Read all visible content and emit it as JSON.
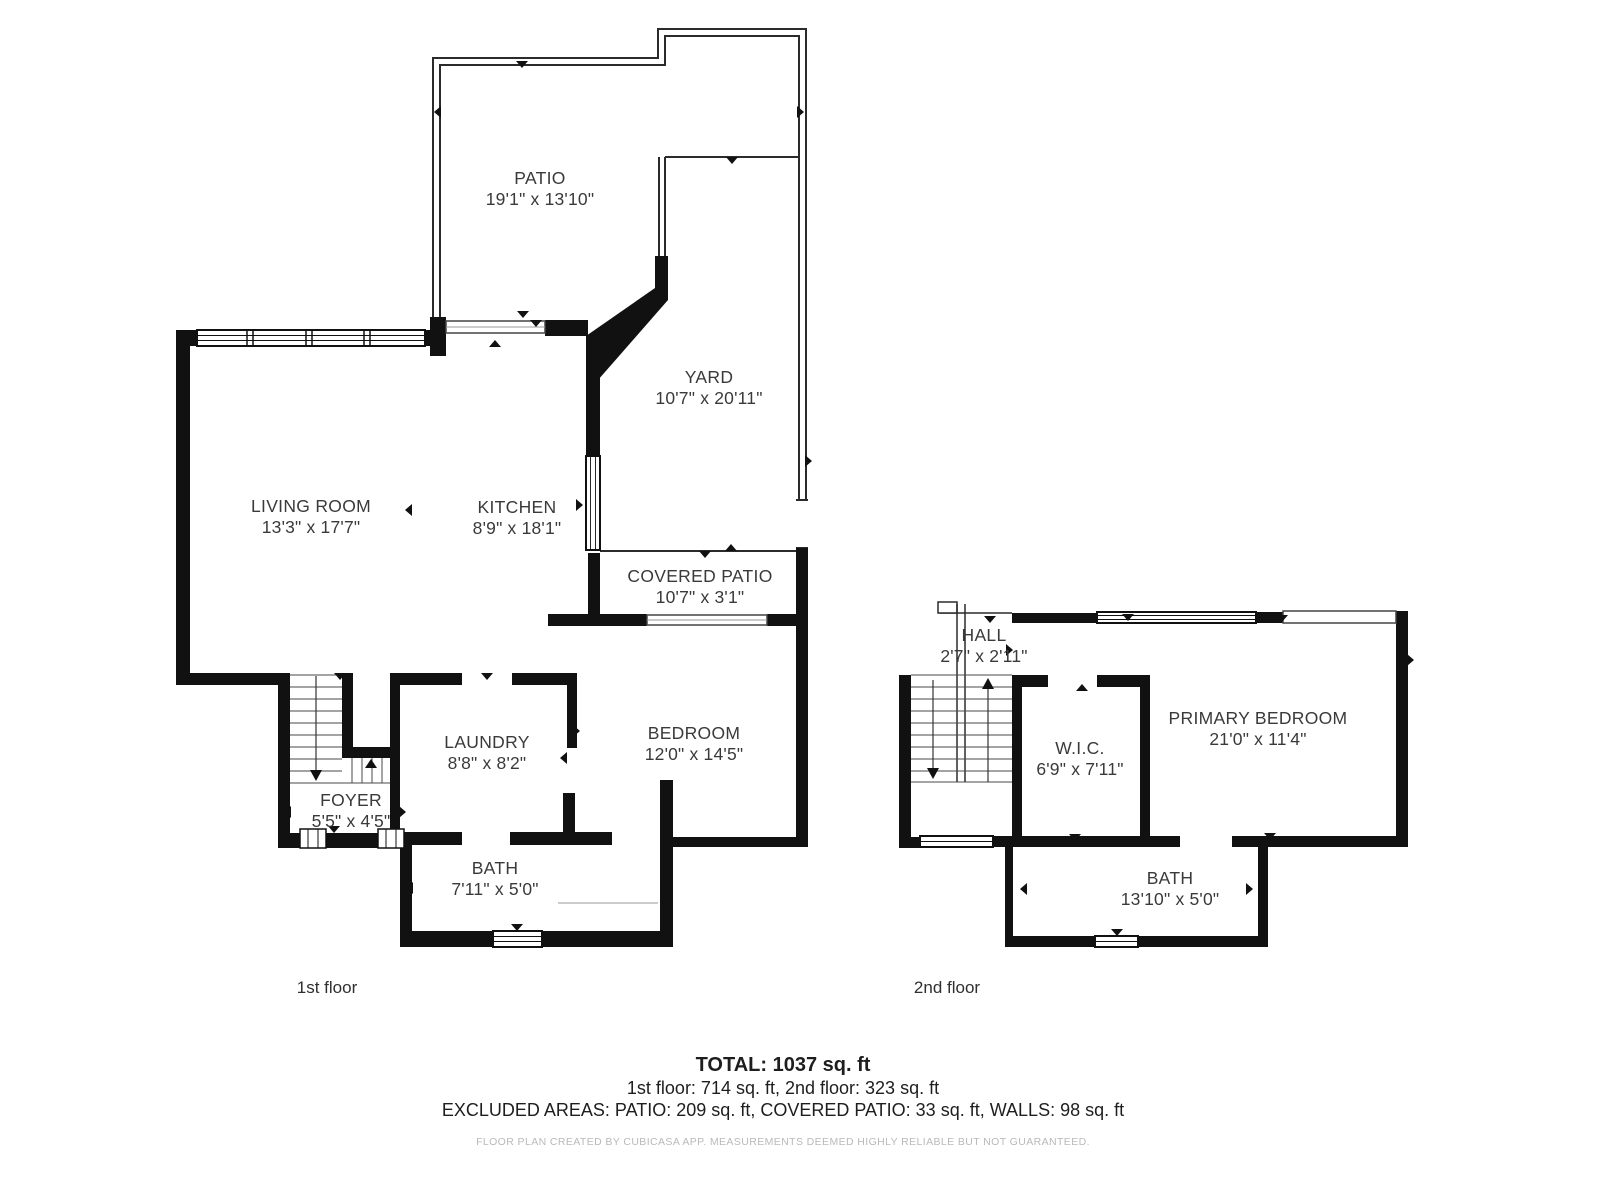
{
  "floor1": {
    "caption": "1st floor",
    "rooms": [
      {
        "name": "PATIO",
        "dims": "19'1\" x 13'10\""
      },
      {
        "name": "YARD",
        "dims": "10'7\" x 20'11\""
      },
      {
        "name": "LIVING ROOM",
        "dims": "13'3\" x 17'7\""
      },
      {
        "name": "KITCHEN",
        "dims": "8'9\" x 18'1\""
      },
      {
        "name": "COVERED PATIO",
        "dims": "10'7\" x 3'1\""
      },
      {
        "name": "BEDROOM",
        "dims": "12'0\" x 14'5\""
      },
      {
        "name": "LAUNDRY",
        "dims": "8'8\" x 8'2\""
      },
      {
        "name": "FOYER",
        "dims": "5'5\" x 4'5\""
      },
      {
        "name": "BATH",
        "dims": "7'11\" x 5'0\""
      }
    ]
  },
  "floor2": {
    "caption": "2nd floor",
    "rooms": [
      {
        "name": "HALL",
        "dims": "2'7\" x 2'11\""
      },
      {
        "name": "W.I.C.",
        "dims": "6'9\" x 7'11\""
      },
      {
        "name": "PRIMARY BEDROOM",
        "dims": "21'0\" x 11'4\""
      },
      {
        "name": "BATH",
        "dims": "13'10\" x 5'0\""
      }
    ]
  },
  "summary": {
    "total": "TOTAL: 1037 sq. ft",
    "floors": "1st floor: 714 sq. ft, 2nd floor: 323 sq. ft",
    "excluded": "EXCLUDED AREAS: PATIO: 209 sq. ft, COVERED PATIO: 33 sq. ft, WALLS: 98 sq. ft"
  },
  "footer": "FLOOR PLAN CREATED BY CUBICASA APP. MEASUREMENTS DEEMED HIGHLY RELIABLE BUT NOT GUARANTEED."
}
